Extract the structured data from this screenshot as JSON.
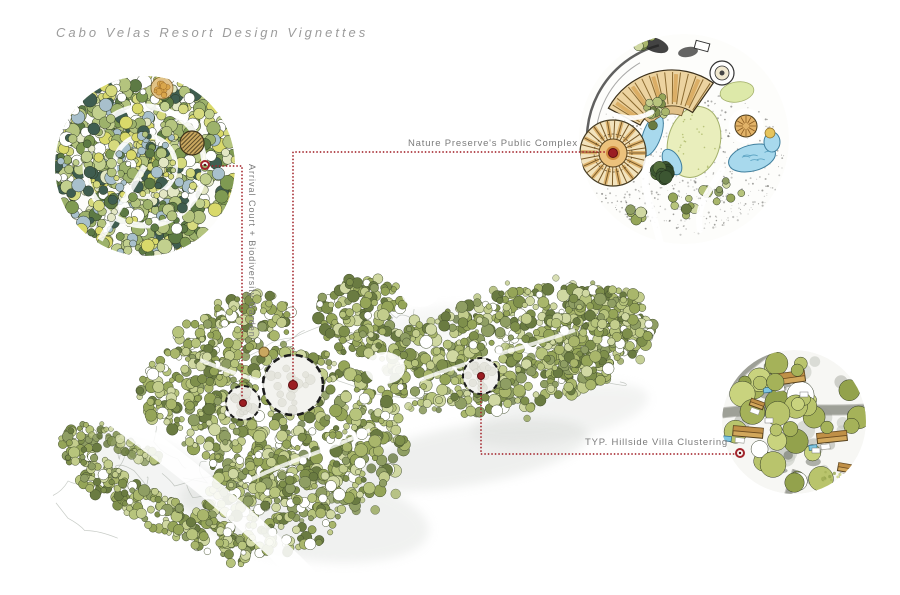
{
  "title": "Cabo Velas Resort Design Vignettes",
  "vignettes": {
    "arrival": {
      "label": "Arrival Court + Biodiversity Garden"
    },
    "nature": {
      "label": "Nature Preserve's Public Complex"
    },
    "villa": {
      "label": "TYP. Hillside Villa Clustering"
    }
  },
  "colors": {
    "accent_red": "#a3242b",
    "marker_red": "#9b1d22",
    "marker_dark": "#5e0e12",
    "title_gray": "#9c9c9c",
    "label_gray": "#7b7b7b",
    "plaza_white": "#f3f3ef",
    "water_blue": "#a8d9ed",
    "lawn_green": "#e9eebc",
    "roof_tan": "#d2a75b",
    "roof_brown": "#b8863e",
    "pool_blue": "#7fc6e2",
    "tree_palette": [
      "#a9b66b",
      "#95a558",
      "#c3cd8c",
      "#7e8f4b",
      "#b7c47c",
      "#6a7b41",
      "#d0d8a2",
      "#8f9e63"
    ],
    "garden_palette": [
      "#9db26b",
      "#7f9a52",
      "#c2d08e",
      "#5d7a44",
      "#d6da7e",
      "#b4c47e",
      "#3f5d50",
      "#a8c0cc",
      "#e3e7c4",
      "#d9d96a"
    ],
    "dark_palette": [
      "#3c5632",
      "#2e4628",
      "#55703c"
    ],
    "villa_palette": [
      "#b9c46c",
      "#a5b259",
      "#c9d37e",
      "#93a24c"
    ]
  }
}
